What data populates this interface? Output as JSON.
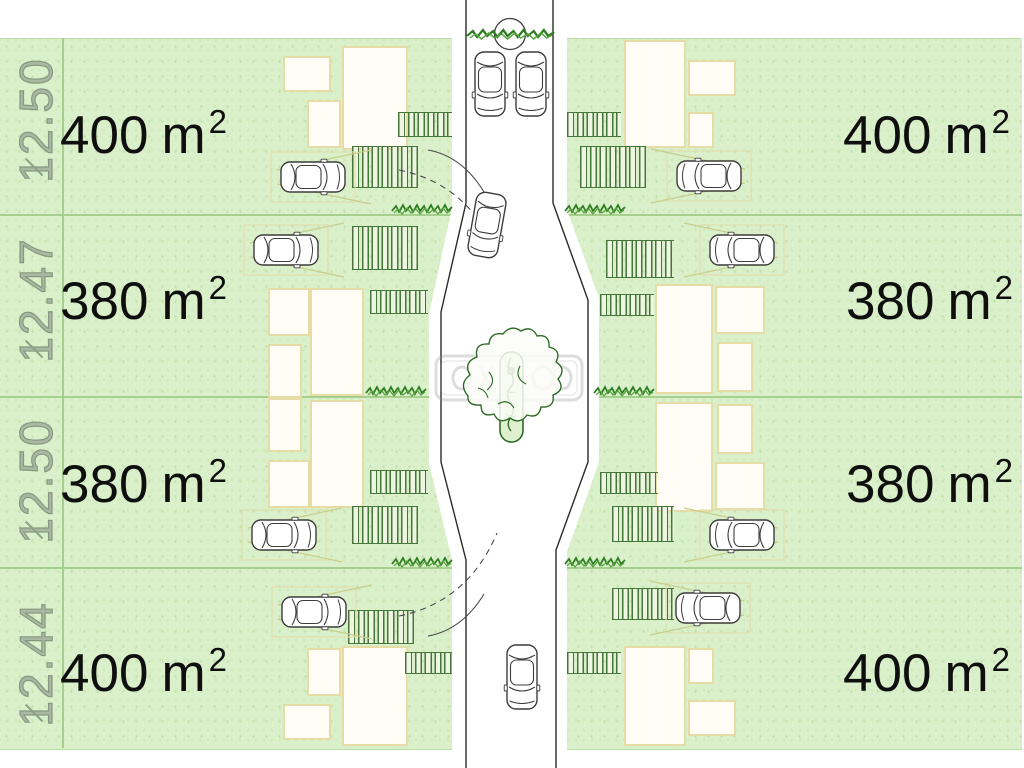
{
  "title": "Residential subdivision site plan",
  "lots": [
    {
      "id": "lot-left-row1",
      "side": "left",
      "row": 1,
      "area": "400",
      "unit": "m",
      "sup": "2"
    },
    {
      "id": "lot-left-row2",
      "side": "left",
      "row": 2,
      "area": "380",
      "unit": "m",
      "sup": "2"
    },
    {
      "id": "lot-left-row3",
      "side": "left",
      "row": 3,
      "area": "380",
      "unit": "m",
      "sup": "2"
    },
    {
      "id": "lot-left-row4",
      "side": "left",
      "row": 4,
      "area": "400",
      "unit": "m",
      "sup": "2"
    },
    {
      "id": "lot-right-row1",
      "side": "right",
      "row": 1,
      "area": "400",
      "unit": "m",
      "sup": "2"
    },
    {
      "id": "lot-right-row2",
      "side": "right",
      "row": 2,
      "area": "380",
      "unit": "m",
      "sup": "2"
    },
    {
      "id": "lot-right-row3",
      "side": "right",
      "row": 3,
      "area": "380",
      "unit": "m",
      "sup": "2"
    },
    {
      "id": "lot-right-row4",
      "side": "right",
      "row": 4,
      "area": "400",
      "unit": "m",
      "sup": "2"
    }
  ],
  "dimensions": [
    {
      "label": "12.50",
      "row": 1
    },
    {
      "label": "12.47",
      "row": 2
    },
    {
      "label": "12.50",
      "row": 3
    },
    {
      "label": "12.44",
      "row": 4
    }
  ],
  "watermark": {
    "present": true,
    "legible": false
  },
  "icons": {
    "car": "car-top-view",
    "tree": "tree-canopy",
    "bush": "round-bush",
    "hedge": "hedge-row",
    "median": "planted-median"
  },
  "colors": {
    "lot_green": "#daf0ca",
    "divider_green": "#a6cf8e",
    "hatch_green": "#47763c",
    "house_outline": "#e6dca6",
    "road_line": "#2b2b2b",
    "label_text": "#0f0f0f",
    "dimension_text": "#85987f"
  }
}
